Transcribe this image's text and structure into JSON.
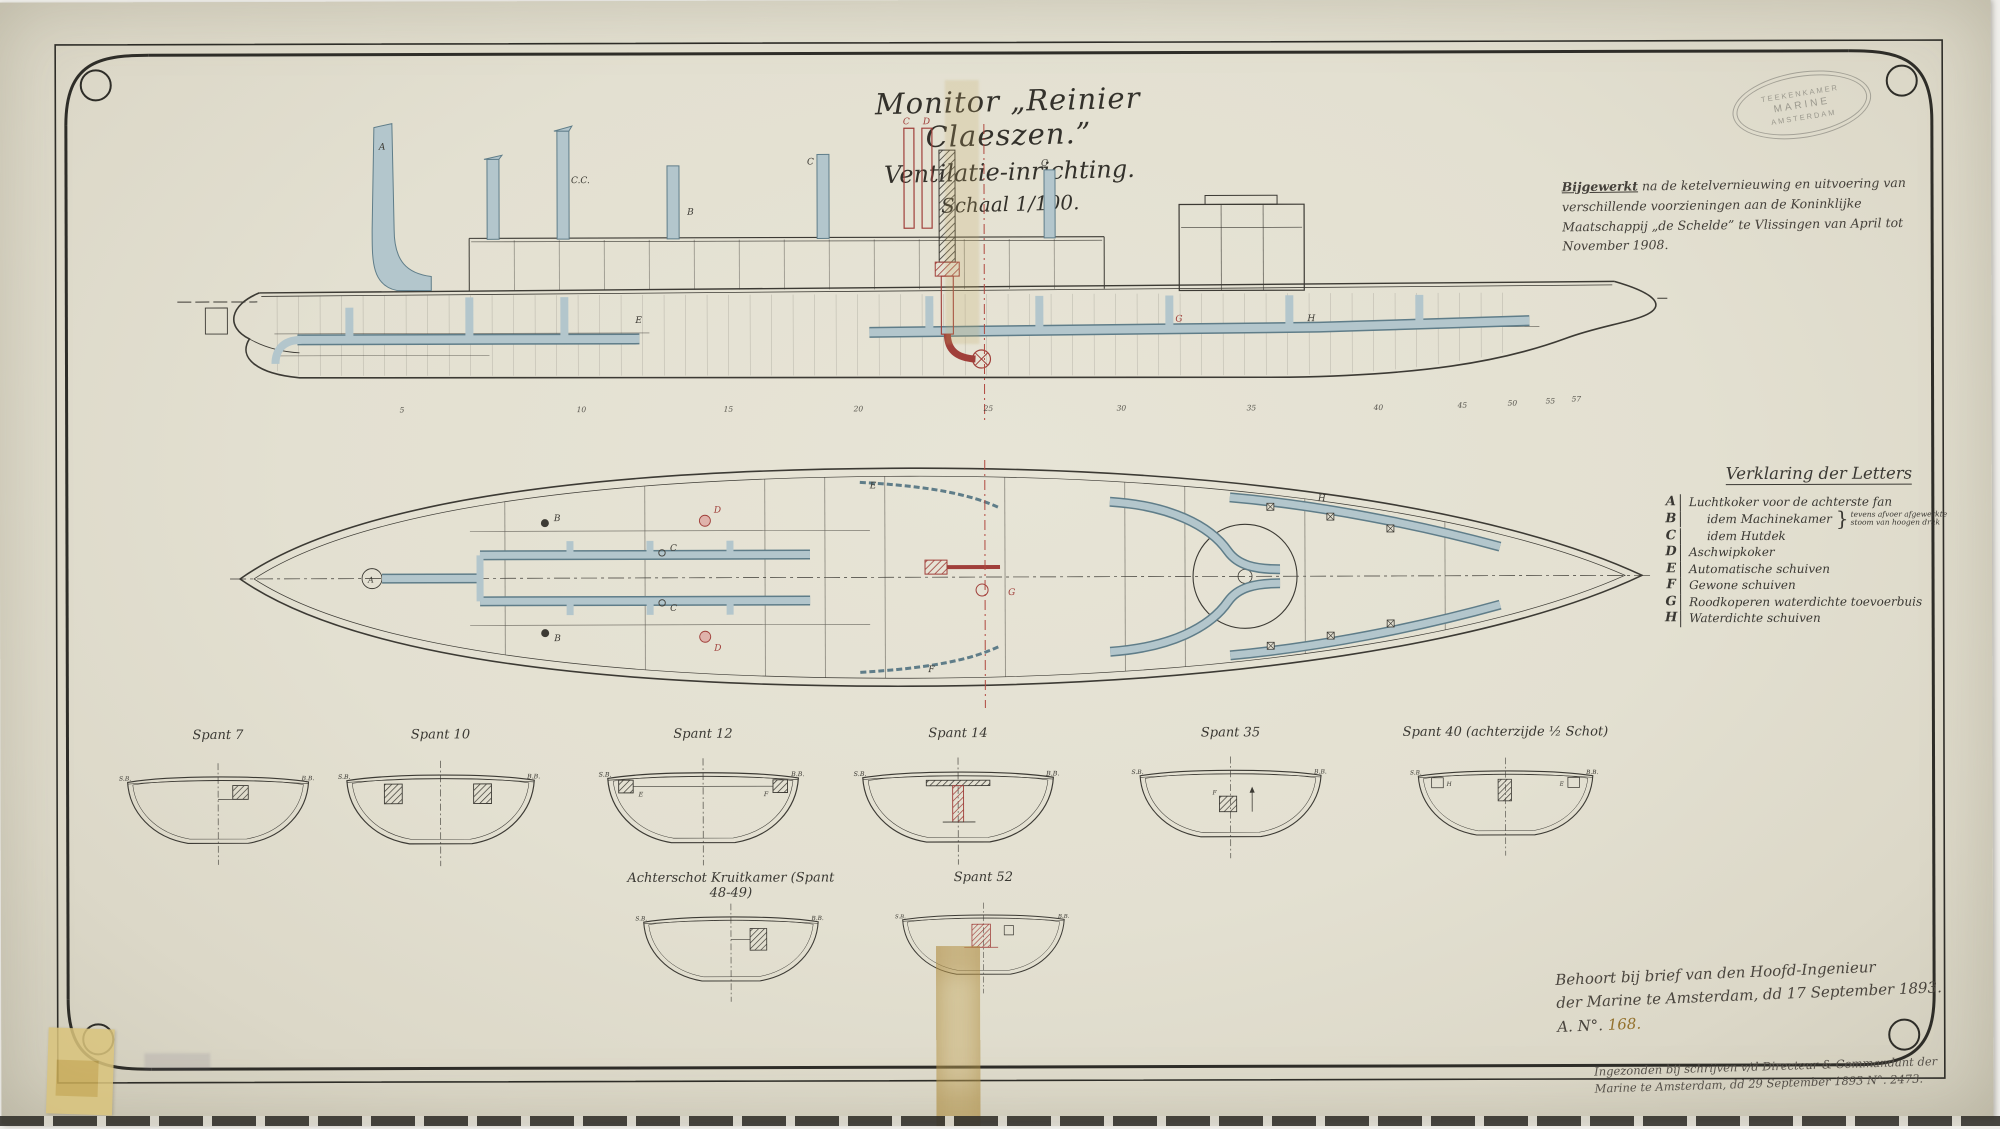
{
  "title": {
    "line1": "Monitor „Reinier Claeszen.”",
    "line2": "Ventilatie-inrichting.",
    "line3": "Schaal 1/100."
  },
  "stamp": {
    "top": "TEEKENKAMER",
    "middle": "MARINE",
    "bottom": "AMSTERDAM"
  },
  "revision_note": {
    "lead": "Bijgewerkt",
    "rest": " na de ketelvernieuwing en uitvoering van verschillende voorzieningen aan de Koninklijke Maatschappij „de Schelde” te Vlissingen van April tot November 1908."
  },
  "legend": {
    "title": "Verklaring der Letters",
    "items": [
      {
        "letter": "A",
        "label": "Luchtkoker voor de achterste fan"
      },
      {
        "letter": "B",
        "label": "idem Machinekamer",
        "note1": "tevens afvoer afgewerkte",
        "note2": "stoom van hoogen druk"
      },
      {
        "letter": "C",
        "label": "idem Hutdek"
      },
      {
        "letter": "D",
        "label": "Aschwipkoker"
      },
      {
        "letter": "E",
        "label": "Automatische schuiven"
      },
      {
        "letter": "F",
        "label": "Gewone schuiven"
      },
      {
        "letter": "G",
        "label": "Roodkoperen waterdichte toevoerbuis"
      },
      {
        "letter": "H",
        "label": "Waterdichte schuiven"
      }
    ]
  },
  "sections": {
    "side_label_left": "S.B.",
    "side_label_right": "B.B.",
    "row1": [
      {
        "label": "Spant 7"
      },
      {
        "label": "Spant 10"
      },
      {
        "label": "Spant 12"
      },
      {
        "label": "Spant 14"
      },
      {
        "label": "Spant 35"
      },
      {
        "label": "Spant 40 (achterzijde ½ Schot)"
      }
    ],
    "row2": [
      {
        "label": "Achterschot Kruitkamer (Spant 48-49)"
      },
      {
        "label": "Spant 52"
      }
    ]
  },
  "frame_numbers": [
    "5",
    "10",
    "15",
    "20",
    "25",
    "30",
    "35",
    "40",
    "45",
    "50",
    "55",
    "57"
  ],
  "drawing_letters": {
    "A": "A",
    "B": "B",
    "C": "C",
    "CC": "C.C.",
    "D": "D",
    "E": "E",
    "F": "F",
    "G": "G",
    "H": "H"
  },
  "annotations": {
    "behoort_line1": "Behoort bij brief van den Hoofd-Ingenieur",
    "behoort_line2": "der Marine te Amsterdam, dd 17 September 1893.",
    "behoort_line3_prefix": "A. N°. ",
    "behoort_line3_number": "168.",
    "ingezonden_line1": "Ingezonden bij schrijven v/d Directeur & Commandant der",
    "ingezonden_line2": "Marine te Amsterdam, dd 29 September 1893 N°. 2473."
  },
  "colors": {
    "paper": "#e3e0d2",
    "ink": "#3c3a34",
    "steel_blue": "#b3c6cc",
    "steel_outline": "#5f7d89",
    "red": "#a03f3a",
    "tape": "#d6bd75"
  }
}
